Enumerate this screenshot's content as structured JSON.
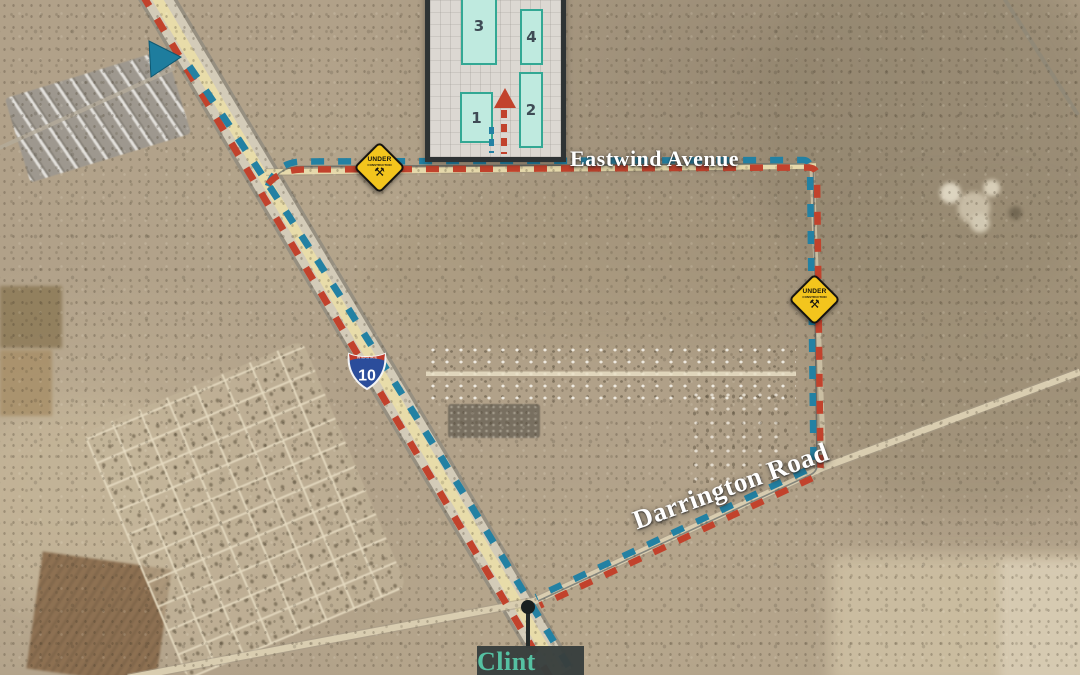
{
  "title": "Clint Exit aerial route map",
  "road_labels": {
    "eastwind": "Eastwind Avenue",
    "darrington": "Darrington Road"
  },
  "exit_callout": {
    "label": "Clint Exit"
  },
  "interstate_shield": {
    "band": "INTERSTATE",
    "number": "10"
  },
  "construction_signs": [
    {
      "line1": "UNDER",
      "line2": "CONSTRUCTION",
      "icon": "⚒"
    },
    {
      "line1": "UNDER",
      "line2": "CONSTRUCTION",
      "icon": "⚒"
    }
  ],
  "site_plan_inset": {
    "buildings": [
      {
        "label": "3"
      },
      {
        "label": "4"
      },
      {
        "label": "1"
      },
      {
        "label": "2"
      }
    ]
  },
  "colors": {
    "route_red": "#c2422c",
    "route_blue": "#2381a3",
    "route_outline_dark": "#223340",
    "sign_yellow": "#f3c51d",
    "exit_text_teal": "#55c1a2",
    "exit_box_dark": "#383f3e",
    "building_fill": "#bfeadf",
    "building_border": "#33a894",
    "shield_blue": "#2b4d9b",
    "shield_red": "#bf3a2b",
    "arrow_teal": "#1e7d9e",
    "callout_dot": "#1a201f"
  }
}
